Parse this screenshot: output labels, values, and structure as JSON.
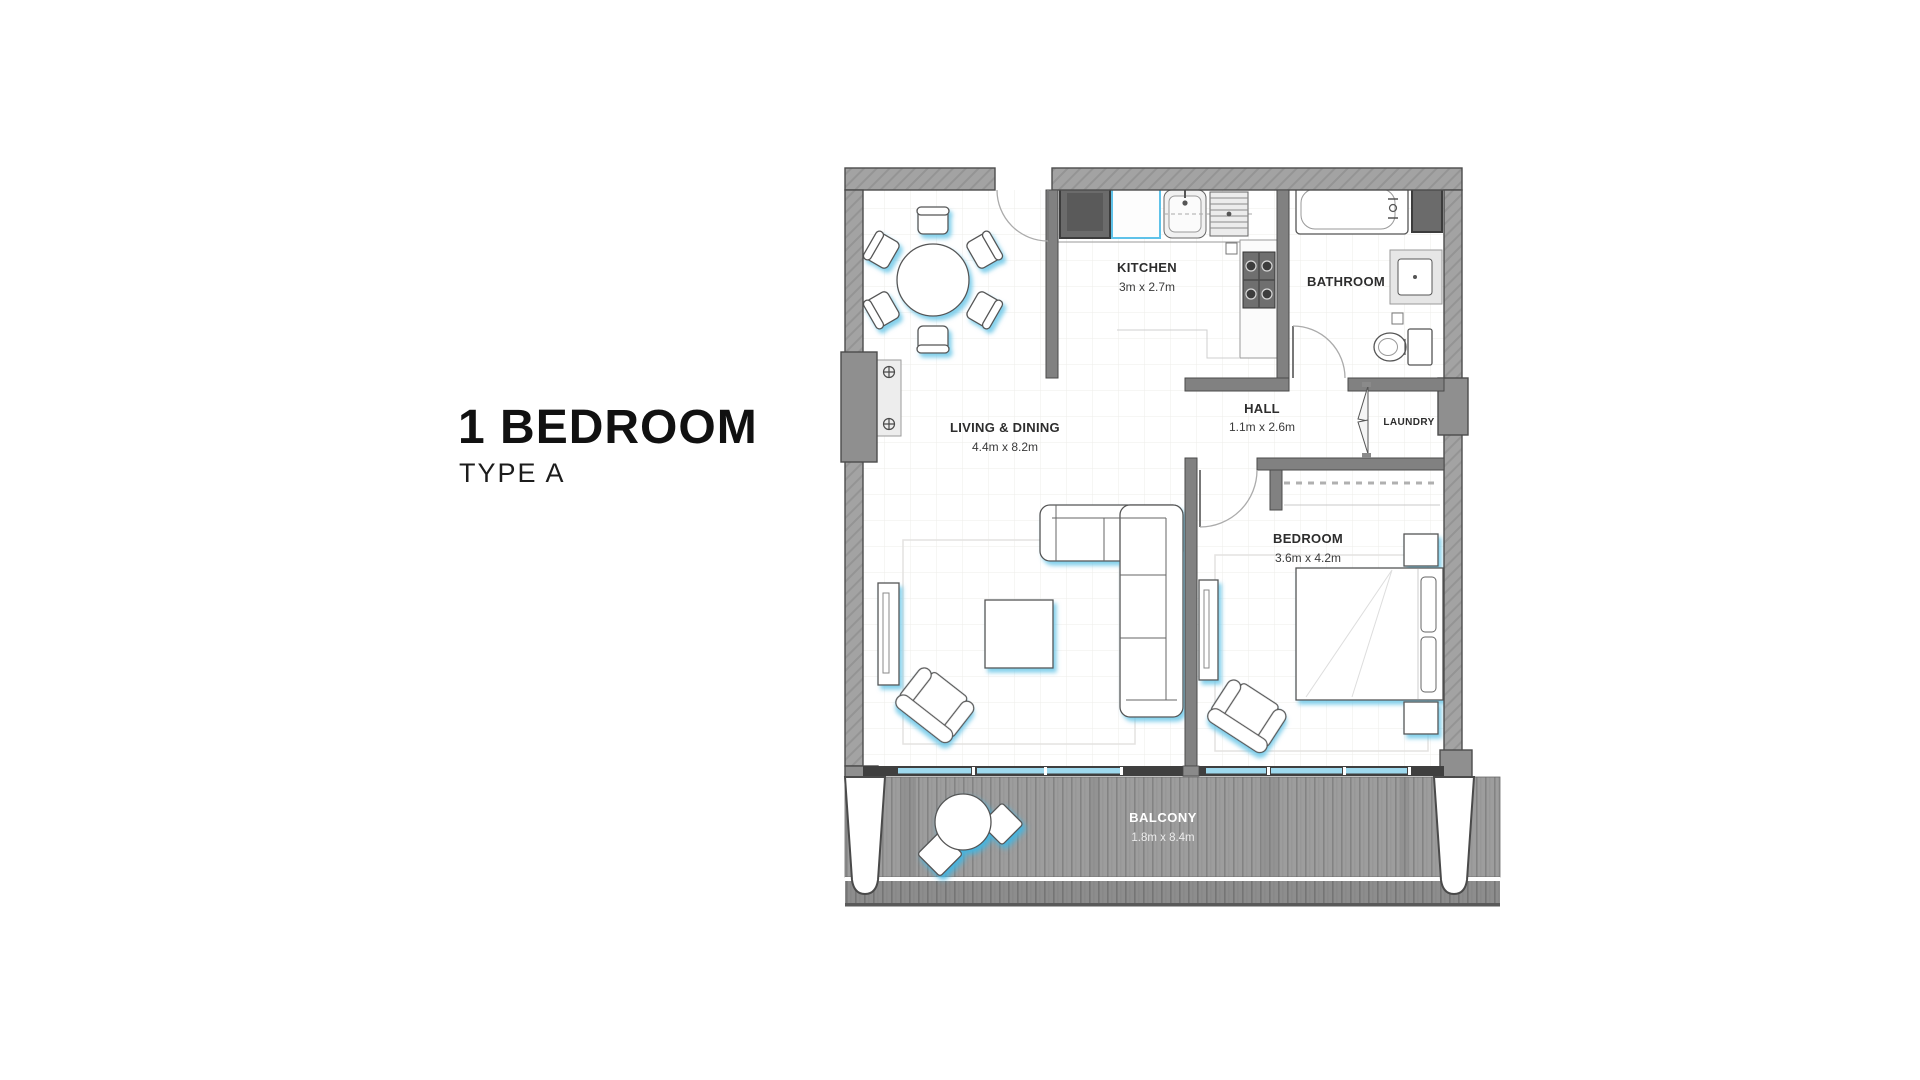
{
  "title": {
    "heading": "1 BEDROOM",
    "subtitle": "TYPE A"
  },
  "rooms": {
    "living": {
      "name": "LIVING & DINING",
      "dims": "4.4m x 8.2m"
    },
    "kitchen": {
      "name": "KITCHEN",
      "dims": "3m x 2.7m"
    },
    "bathroom": {
      "name": "BATHROOM"
    },
    "hall": {
      "name": "HALL",
      "dims": "1.1m x 2.6m"
    },
    "laundry": {
      "name": "LAUNDRY"
    },
    "bedroom": {
      "name": "BEDROOM",
      "dims": "3.6m x 4.2m"
    },
    "balcony": {
      "name": "BALCONY",
      "dims": "1.8m x 8.4m"
    }
  },
  "colors": {
    "furniture_glow_blue": "#6ec8e8",
    "glazing_blue": "#9ed9ee",
    "appliance_accent_blue": "#5fc2e9",
    "wall_gray": "#a3a3a3",
    "deck_gray": "#9d9d9d",
    "text_dark": "#2d2d2d"
  }
}
